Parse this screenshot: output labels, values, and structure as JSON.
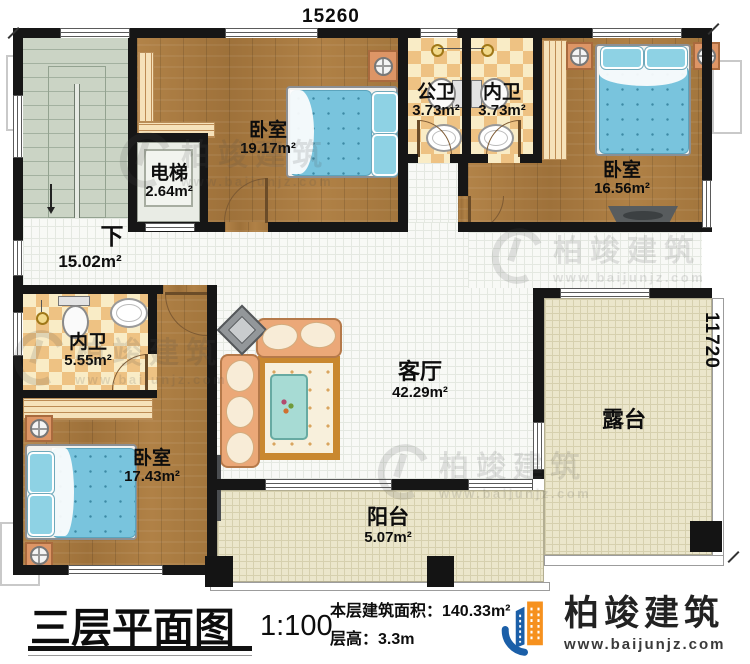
{
  "dimensions": {
    "top": "15260",
    "right": "11720"
  },
  "rooms": {
    "bedroom1": {
      "label": "卧室",
      "area": "19.17m²"
    },
    "elevator": {
      "label": "电梯",
      "area": "2.64m²"
    },
    "public_bath": {
      "label": "公卫",
      "area": "3.73m²"
    },
    "inner_bath": {
      "label": "内卫",
      "area": "3.73m²"
    },
    "bedroom2": {
      "label": "卧室",
      "area": "16.56m²"
    },
    "hall": {
      "area": "15.02m²"
    },
    "stairs": {
      "label": "下"
    },
    "inner_bath2": {
      "label": "内卫",
      "area": "5.55m²"
    },
    "bedroom3": {
      "label": "卧室",
      "area": "17.43m²"
    },
    "living": {
      "label": "客厅",
      "area": "42.29m²"
    },
    "terrace": {
      "label": "露台"
    },
    "balcony": {
      "label": "阳台",
      "area": "5.07m²"
    }
  },
  "footer": {
    "title": "三层平面图",
    "scale": "1:100",
    "area_line": "本层建筑面积：140.33m²",
    "height_line": "层高：3.3m"
  },
  "brand": {
    "name": "柏竣建筑",
    "url": "www.baijunjz.com"
  },
  "colors": {
    "wall": "#161616",
    "wood": "#a97c42",
    "tile_dark": "#eec283",
    "tile_light": "#f9ecc6",
    "mattress": "#79c4dd",
    "stairs": "#cbd4c5",
    "terrace": "#ebe6cb",
    "brand_blue": "#1b5fa8",
    "brand_orange": "#f6911e"
  }
}
